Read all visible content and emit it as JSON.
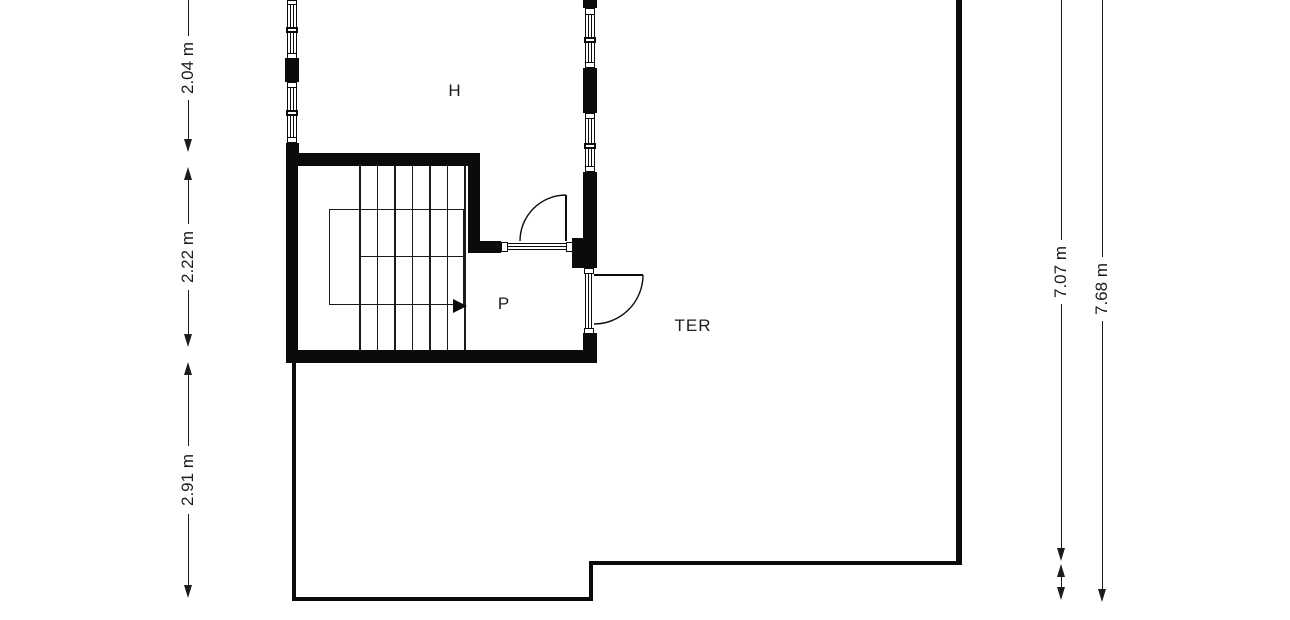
{
  "rooms": {
    "h": {
      "label": "H"
    },
    "p": {
      "label": "P"
    },
    "ter": {
      "label": "TER"
    }
  },
  "dimensions": {
    "d204": {
      "label": "2.04 m"
    },
    "d222": {
      "label": "2.22 m"
    },
    "d291": {
      "label": "2.91 m"
    },
    "d707": {
      "label": "7.07 m"
    },
    "d768": {
      "label": "7.68 m"
    }
  },
  "colors": {
    "wall": "#0b0b0b",
    "line": "#1c1c1c",
    "background": "#ffffff"
  }
}
